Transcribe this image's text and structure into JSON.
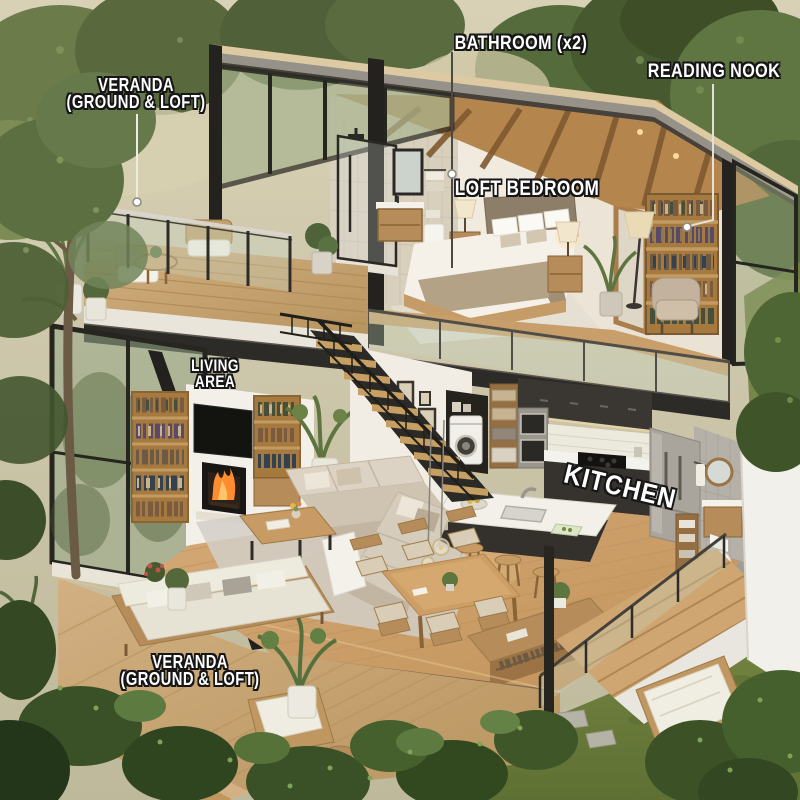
{
  "labels": {
    "veranda_loft": {
      "line1": "VERANDA",
      "line2": "(GROUND & LOFT)"
    },
    "bathroom": {
      "text": "BATHROOM (x2)"
    },
    "reading_nook": {
      "text": "READING NOOK"
    },
    "loft_bedroom": {
      "text": "LOFT BEDROOM"
    },
    "living_area": {
      "line1": "LIVING",
      "line2": "AREA"
    },
    "kitchen": {
      "text": "KITCHEN"
    },
    "veranda_ground": {
      "line1": "VERANDA",
      "line2": "(GROUND & LOFT)"
    }
  },
  "palette": {
    "label_text": "#ffffff",
    "label_outline": "#161616",
    "roof_wood": "#ddcaa2",
    "roof_fascia_gray": "#96928a",
    "frame_dark": "#26251f",
    "wall_white": "#f1ede6",
    "tile_beige": "#d8cfbc",
    "rafter_wood": "#b5854e",
    "wood_floor": "#cfa671",
    "deck_wood": "#c9a876",
    "sofa_beige": "#d6ccbc",
    "bed_linen": "#f5f1e9",
    "headboard": "#8d7e6a",
    "bookshelf_wood": "#a6793f",
    "kitchen_cabinet": "#36322d",
    "counter_white": "#f3f1ea",
    "stainless": "#aaa59c",
    "fire_orange": "#ff8c2e",
    "foliage_green": "#5d7240",
    "grass_green": "#7c8c46",
    "glass_tint": "#c8d7c3"
  }
}
